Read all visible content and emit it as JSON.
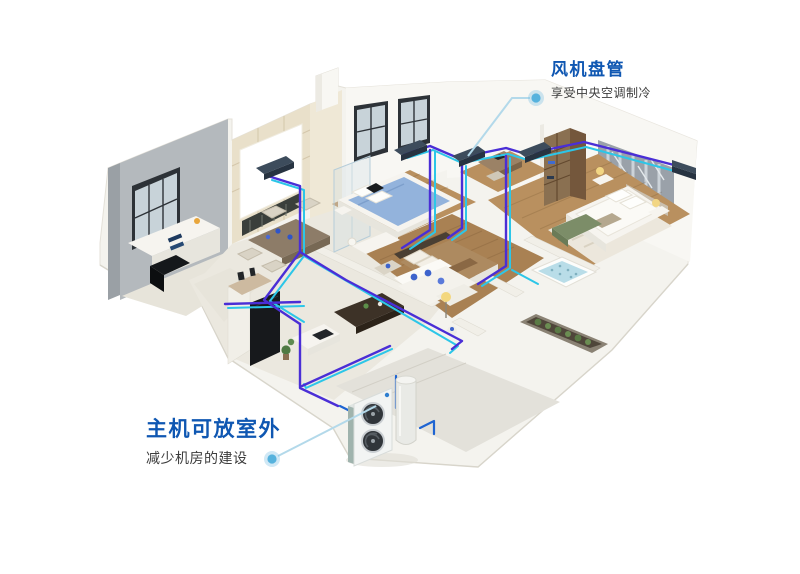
{
  "callouts": {
    "fan_coil": {
      "title": "风机盘管",
      "subtitle": "享受中央空调制冷"
    },
    "outdoor_unit": {
      "title": "主机可放室外",
      "subtitle": "减少机房的建设"
    }
  },
  "colors": {
    "accent_blue": "#0f57b2",
    "text_dark": "#3c3c3c",
    "pipe_indigo": "#4a2ed6",
    "pipe_cyan": "#2cc6e8",
    "pipe_blue": "#1e64d2",
    "leader_line": "#b3d9ea",
    "leader_dot": "#56b2dd"
  }
}
